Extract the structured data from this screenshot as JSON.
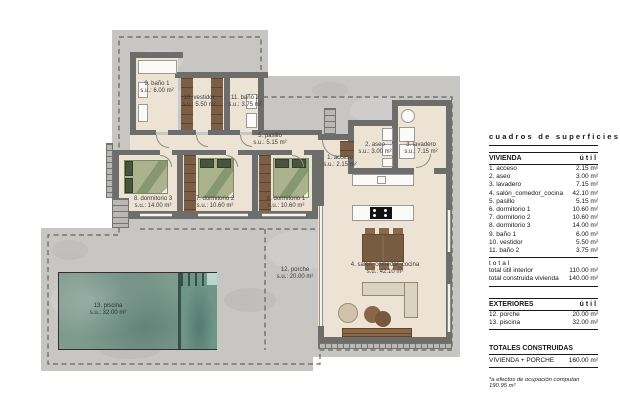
{
  "sheet_title": "cuadros de superficies",
  "panel": {
    "vivienda": {
      "header": "VIVIENDA",
      "unit_col": "útil",
      "rows": [
        {
          "label": "1. acceso",
          "value": "2.15 m²"
        },
        {
          "label": "2. aseo",
          "value": "3.00 m²"
        },
        {
          "label": "3. lavadero",
          "value": "7.15 m²"
        },
        {
          "label": "4. salón_comedor_cocina",
          "value": "42.10 m²"
        },
        {
          "label": "5. pasillo",
          "value": "5.15 m²"
        },
        {
          "label": "6. dormitorio 1",
          "value": "10.60 m²"
        },
        {
          "label": "7. dormitorio 2",
          "value": "10.60 m²"
        },
        {
          "label": "8. dormitorio 3",
          "value": "14.00 m²"
        },
        {
          "label": "9. baño 1",
          "value": "6.00 m²"
        },
        {
          "label": "10. vestidor",
          "value": "5.50 m²"
        },
        {
          "label": "11. baño 2",
          "value": "3.75 m²"
        }
      ],
      "total_label": "total",
      "totals": [
        {
          "label": "total útil interior",
          "value": "110.00 m²"
        },
        {
          "label": "total construida vivienda",
          "value": "140.00 m²"
        }
      ]
    },
    "exteriores": {
      "header": "EXTERIORES",
      "unit_col": "útil",
      "rows": [
        {
          "label": "12. porche",
          "value": "20.00 m²"
        },
        {
          "label": "13. piscina",
          "value": "32.00 m²"
        }
      ]
    },
    "totales": {
      "header": "TOTALES CONSTRUIDAS",
      "rows": [
        {
          "label": "VIVIENDA + PORCHE",
          "value": "160.00 m²"
        }
      ],
      "footnote": "*a efectos de ocupación computan 190.95 m²"
    }
  },
  "plan": {
    "rooms": [
      {
        "name": "1. acceso",
        "area": "s.u.: 2.15 m²"
      },
      {
        "name": "2. aseo",
        "area": "s.u.: 3.00 m²"
      },
      {
        "name": "3. lavadero",
        "area": "s.u.: 7.15 m²"
      },
      {
        "name": "4. salón_comedor_cocina",
        "area": "s.u.: 42.10 m²"
      },
      {
        "name": "5. pasillo",
        "area": "s.u.: 5.15 m²"
      },
      {
        "name": "6. dormitorio 1",
        "area": "s.u.: 10.60 m²"
      },
      {
        "name": "7. dormitorio 2",
        "area": "s.u.: 10.60 m²"
      },
      {
        "name": "8. dormitorio 3",
        "area": "s.u.: 14.00 m²"
      },
      {
        "name": "9. baño 1",
        "area": "s.u.: 6.00 m²"
      },
      {
        "name": "10. vestidor",
        "area": "s.u.: 5.50 m²"
      },
      {
        "name": "11. baño 2",
        "area": "s.u.: 3.75 m²"
      },
      {
        "name": "12. porche",
        "area": "s.u.: 20.00 m²"
      },
      {
        "name": "13. piscina",
        "area": "s.u.: 32.00 m²"
      }
    ]
  },
  "colors": {
    "plot_concrete": "#c7c6c3",
    "wall": "#6d6d6b",
    "floor": "#ece3d4",
    "wardrobe": "#7b5e45",
    "bed": "#aab38d",
    "pool_water": "#7e9b90",
    "dashed_line": "#63635f"
  }
}
